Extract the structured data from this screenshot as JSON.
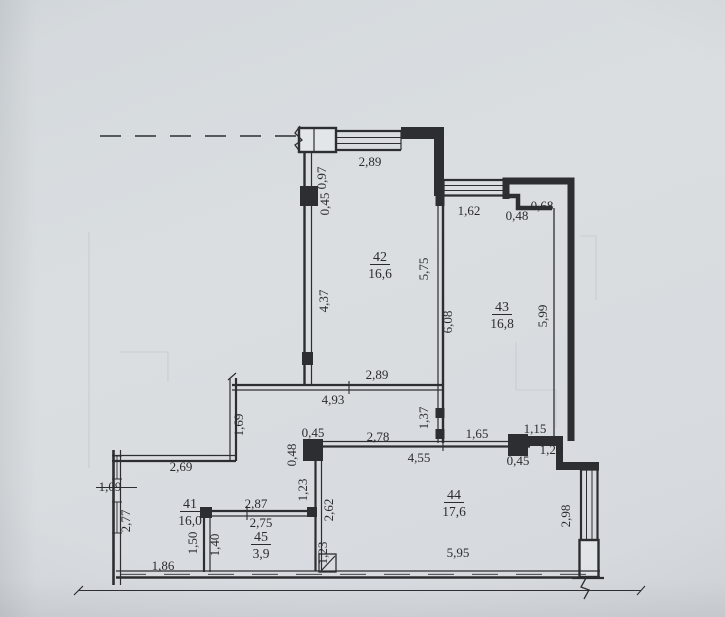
{
  "page": {
    "background_color": "#d6dadd",
    "line_color": "#202124",
    "paper_tint": "#dfe3e6"
  },
  "floorplan": {
    "rooms": [
      {
        "number": "41",
        "area": "16,0",
        "x": 190,
        "y": 508
      },
      {
        "number": "42",
        "area": "16,6",
        "x": 380,
        "y": 261
      },
      {
        "number": "43",
        "area": "16,8",
        "x": 502,
        "y": 311
      },
      {
        "number": "44",
        "area": "17,6",
        "x": 454,
        "y": 499
      },
      {
        "number": "45",
        "area": "3,9",
        "x": 261,
        "y": 541
      }
    ],
    "dimensions": [
      {
        "text": "2,89",
        "x": 370,
        "y": 166,
        "rot": 0
      },
      {
        "text": "0,97",
        "x": 326,
        "y": 174,
        "rot": 1
      },
      {
        "text": "0,45",
        "x": 329,
        "y": 200,
        "rot": 1
      },
      {
        "text": "1,62",
        "x": 469,
        "y": 215,
        "rot": 0
      },
      {
        "text": "0,48",
        "x": 517,
        "y": 220,
        "rot": 0
      },
      {
        "text": "0,68",
        "x": 542,
        "y": 210,
        "rot": 0
      },
      {
        "text": "5,75",
        "x": 428,
        "y": 265,
        "rot": 1
      },
      {
        "text": "6,08",
        "x": 452,
        "y": 318,
        "rot": 1
      },
      {
        "text": "5,99",
        "x": 547,
        "y": 312,
        "rot": 1
      },
      {
        "text": "4,37",
        "x": 328,
        "y": 297,
        "rot": 1
      },
      {
        "text": "2,89",
        "x": 377,
        "y": 379,
        "rot": 0
      },
      {
        "text": "4,93",
        "x": 333,
        "y": 404,
        "rot": 0
      },
      {
        "text": "1,37",
        "x": 428,
        "y": 414,
        "rot": 1
      },
      {
        "text": "1,69",
        "x": 243,
        "y": 421,
        "rot": 1
      },
      {
        "text": "0,45",
        "x": 313,
        "y": 437,
        "rot": 0
      },
      {
        "text": "2,78",
        "x": 378,
        "y": 441,
        "rot": 0
      },
      {
        "text": "1,65",
        "x": 477,
        "y": 438,
        "rot": 0
      },
      {
        "text": "1,15",
        "x": 535,
        "y": 433,
        "rot": 0
      },
      {
        "text": "1,20",
        "x": 551,
        "y": 454,
        "rot": 0
      },
      {
        "text": "0,45",
        "x": 518,
        "y": 465,
        "rot": 0
      },
      {
        "text": "4,55",
        "x": 419,
        "y": 462,
        "rot": 0
      },
      {
        "text": "2,69",
        "x": 181,
        "y": 471,
        "rot": 0
      },
      {
        "text": "0,48",
        "x": 296,
        "y": 451,
        "rot": 1
      },
      {
        "text": "1,23",
        "x": 307,
        "y": 486,
        "rot": 1
      },
      {
        "text": "1,09",
        "x": 110,
        "y": 491,
        "rot": 0
      },
      {
        "text": "2,77",
        "x": 130,
        "y": 517,
        "rot": 1
      },
      {
        "text": "2,87",
        "x": 256,
        "y": 508,
        "rot": 0
      },
      {
        "text": "2,75",
        "x": 261,
        "y": 527,
        "rot": 0
      },
      {
        "text": "1,50",
        "x": 197,
        "y": 539,
        "rot": 1
      },
      {
        "text": "1,40",
        "x": 219,
        "y": 541,
        "rot": 1
      },
      {
        "text": "1,86",
        "x": 163,
        "y": 570,
        "rot": 0
      },
      {
        "text": "2,62",
        "x": 333,
        "y": 506,
        "rot": 1
      },
      {
        "text": "1,23",
        "x": 327,
        "y": 549,
        "rot": 1
      },
      {
        "text": "5,95",
        "x": 458,
        "y": 557,
        "rot": 0
      },
      {
        "text": "2,98",
        "x": 570,
        "y": 512,
        "rot": 1
      }
    ]
  }
}
